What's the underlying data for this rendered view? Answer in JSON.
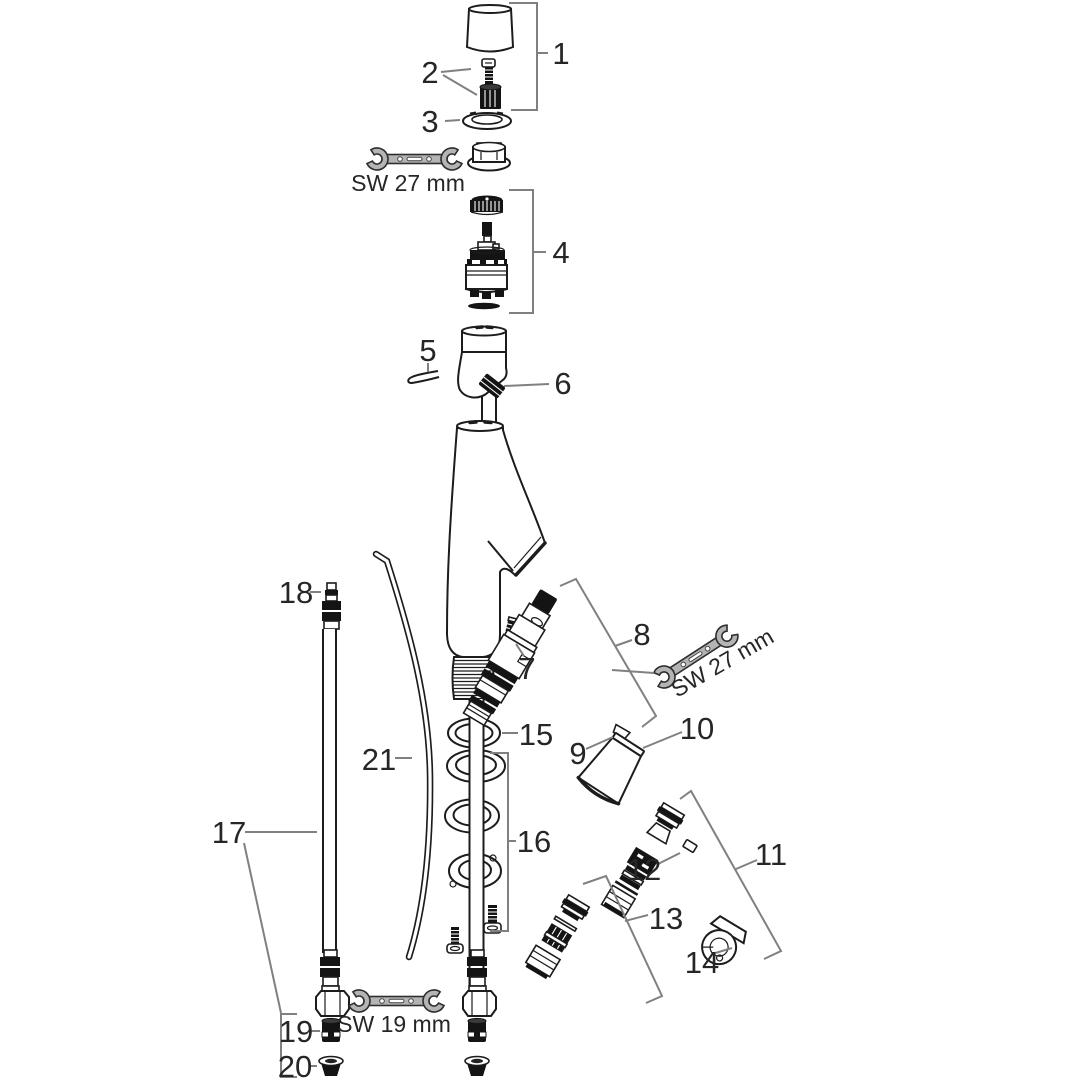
{
  "diagram": {
    "type": "exploded-parts-diagram",
    "background": "#ffffff",
    "colors": {
      "outline": "#1c1c1c",
      "callout": "#808080",
      "wrench_fill": "#b4b4b4",
      "text": "#262626"
    },
    "part_labels": [
      {
        "text": "1"
      },
      {
        "text": "2"
      },
      {
        "text": "3"
      },
      {
        "text": "4"
      },
      {
        "text": "5"
      },
      {
        "text": "6"
      },
      {
        "text": "7"
      },
      {
        "text": "8"
      },
      {
        "text": "9"
      },
      {
        "text": "10"
      },
      {
        "text": "11"
      },
      {
        "text": "12"
      },
      {
        "text": "13"
      },
      {
        "text": "14"
      },
      {
        "text": "15"
      },
      {
        "text": "16"
      },
      {
        "text": "17"
      },
      {
        "text": "18"
      },
      {
        "text": "19"
      },
      {
        "text": "20"
      },
      {
        "text": "21"
      }
    ],
    "tool_labels": [
      {
        "text": "SW 27 mm",
        "position": "top"
      },
      {
        "text": "SW 27 mm",
        "position": "middle-right"
      },
      {
        "text": "SW 19 mm",
        "position": "bottom"
      }
    ]
  }
}
